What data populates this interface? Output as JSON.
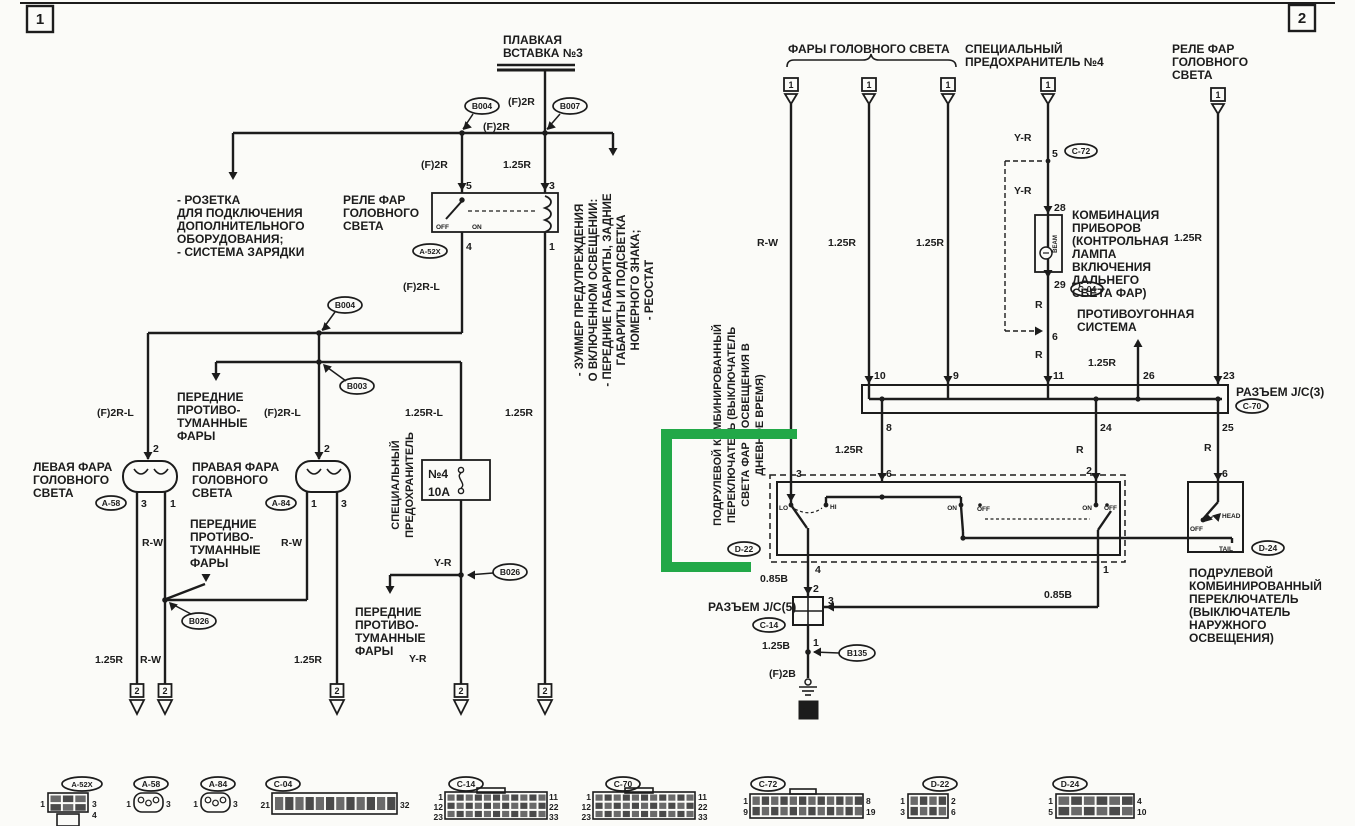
{
  "title": "Схема электрооборудования — фары головного света (стр. 1-2)",
  "colors": {
    "ink": "#1c1c1c",
    "paper": "#fbfbf8",
    "highlight": "#22a848"
  },
  "labels": [
    {
      "t": "1",
      "x": 40,
      "y": 24,
      "s": 15,
      "a": "middle"
    },
    {
      "t": "2",
      "x": 1302,
      "y": 23,
      "s": 15,
      "a": "middle"
    },
    {
      "t": "ПЛАВКАЯ",
      "x": 503,
      "y": 44
    },
    {
      "t": "ВСТАВКА №3",
      "x": 503,
      "y": 57
    },
    {
      "t": "(F)2R",
      "x": 508,
      "y": 105,
      "s": 10.5
    },
    {
      "t": "(F)2R",
      "x": 483,
      "y": 130,
      "s": 10.5
    },
    {
      "t": "(F)2R",
      "x": 421,
      "y": 168,
      "s": 10.5
    },
    {
      "t": "1.25R",
      "x": 503,
      "y": 168,
      "s": 10.5
    },
    {
      "t": "- РОЗЕТКА",
      "x": 177,
      "y": 204
    },
    {
      "t": "ДЛЯ ПОДКЛЮЧЕНИЯ",
      "x": 177,
      "y": 217
    },
    {
      "t": "ДОПОЛНИТЕЛЬНОГО",
      "x": 177,
      "y": 230
    },
    {
      "t": "ОБОРУДОВАНИЯ;",
      "x": 177,
      "y": 243
    },
    {
      "t": "- СИСТЕМА ЗАРЯДКИ",
      "x": 177,
      "y": 256
    },
    {
      "t": "РЕЛЕ ФАР",
      "x": 343,
      "y": 204
    },
    {
      "t": "ГОЛОВНОГО",
      "x": 343,
      "y": 217
    },
    {
      "t": "СВЕТА",
      "x": 343,
      "y": 230
    },
    {
      "t": "5",
      "x": 466,
      "y": 189,
      "s": 10.5
    },
    {
      "t": "3",
      "x": 549,
      "y": 189,
      "s": 10.5
    },
    {
      "t": "4",
      "x": 466,
      "y": 250,
      "s": 10.5
    },
    {
      "t": "1",
      "x": 549,
      "y": 250,
      "s": 10.5
    },
    {
      "t": "OFF",
      "x": 436,
      "y": 229,
      "s": 6.5
    },
    {
      "t": "ON",
      "x": 472,
      "y": 229,
      "s": 6.5
    },
    {
      "t": "(F)2R-L",
      "x": 403,
      "y": 290,
      "s": 10.5
    },
    {
      "t": "(F)2R-L",
      "x": 97,
      "y": 416,
      "s": 10.5
    },
    {
      "t": "(F)2R-L",
      "x": 264,
      "y": 416,
      "s": 10.5
    },
    {
      "t": "1.25R-L",
      "x": 405,
      "y": 416,
      "s": 10.5
    },
    {
      "t": "1.25R",
      "x": 505,
      "y": 416,
      "s": 10.5
    },
    {
      "t": "ПЕРЕДНИЕ",
      "x": 177,
      "y": 401
    },
    {
      "t": "ПРОТИВО-",
      "x": 177,
      "y": 414
    },
    {
      "t": "ТУМАННЫЕ",
      "x": 177,
      "y": 427
    },
    {
      "t": "ФАРЫ",
      "x": 177,
      "y": 440
    },
    {
      "t": "ЛЕВАЯ ФАРА",
      "x": 33,
      "y": 471
    },
    {
      "t": "ГОЛОВНОГО",
      "x": 33,
      "y": 484
    },
    {
      "t": "СВЕТА",
      "x": 33,
      "y": 497
    },
    {
      "t": "ПРАВАЯ ФАРА",
      "x": 192,
      "y": 471
    },
    {
      "t": "ГОЛОВНОГО",
      "x": 192,
      "y": 484
    },
    {
      "t": "СВЕТА",
      "x": 192,
      "y": 497
    },
    {
      "t": "2",
      "x": 153,
      "y": 452,
      "s": 10.5
    },
    {
      "t": "3",
      "x": 141,
      "y": 507,
      "s": 10.5
    },
    {
      "t": "1",
      "x": 170,
      "y": 507,
      "s": 10.5
    },
    {
      "t": "2",
      "x": 324,
      "y": 452,
      "s": 10.5
    },
    {
      "t": "1",
      "x": 311,
      "y": 507,
      "s": 10.5
    },
    {
      "t": "3",
      "x": 341,
      "y": 507,
      "s": 10.5
    },
    {
      "t": "R-W",
      "x": 142,
      "y": 546,
      "s": 10.5
    },
    {
      "t": "R-W",
      "x": 281,
      "y": 546,
      "s": 10.5
    },
    {
      "t": "ПЕРЕДНИЕ",
      "x": 190,
      "y": 528
    },
    {
      "t": "ПРОТИВО-",
      "x": 190,
      "y": 541
    },
    {
      "t": "ТУМАННЫЕ",
      "x": 190,
      "y": 554
    },
    {
      "t": "ФАРЫ",
      "x": 190,
      "y": 567
    },
    {
      "t": "СПЕЦИАЛЬНЫЙ",
      "x": 399,
      "y": 485,
      "r": 1,
      "a": "middle",
      "s": 11
    },
    {
      "t": "ПРЕДОХРАНИТЕЛЬ",
      "x": 413,
      "y": 485,
      "r": 1,
      "a": "middle",
      "s": 11
    },
    {
      "t": "№4",
      "x": 428,
      "y": 478
    },
    {
      "t": "10A",
      "x": 428,
      "y": 496
    },
    {
      "t": "Y-R",
      "x": 434,
      "y": 566,
      "s": 10.5
    },
    {
      "t": "ПЕРЕДНИЕ",
      "x": 355,
      "y": 616
    },
    {
      "t": "ПРОТИВО-",
      "x": 355,
      "y": 629
    },
    {
      "t": "ТУМАННЫЕ",
      "x": 355,
      "y": 642
    },
    {
      "t": "ФАРЫ",
      "x": 355,
      "y": 655
    },
    {
      "t": "1.25R",
      "x": 95,
      "y": 663,
      "s": 10.5
    },
    {
      "t": "R-W",
      "x": 140,
      "y": 663,
      "s": 10.5
    },
    {
      "t": "1.25R",
      "x": 294,
      "y": 663,
      "s": 10.5
    },
    {
      "t": "Y-R",
      "x": 409,
      "y": 662,
      "s": 10.5
    },
    {
      "t": "- ЗУММЕР ПРЕДУПРЕЖДЕНИЯ",
      "x": 583,
      "y": 290,
      "r": 1,
      "a": "middle",
      "s": 11.5
    },
    {
      "t": "О ВКЛЮЧЕННОМ ОСВЕЩЕНИИ:",
      "x": 597,
      "y": 290,
      "r": 1,
      "a": "middle",
      "s": 11.5
    },
    {
      "t": "- ПЕРЕДНИЕ ГАБАРИТЫ, ЗАДНИЕ",
      "x": 611,
      "y": 290,
      "r": 1,
      "a": "middle",
      "s": 11.5
    },
    {
      "t": "ГАБАРИТЫ И ПОДСВЕТКА",
      "x": 625,
      "y": 290,
      "r": 1,
      "a": "middle",
      "s": 11.5
    },
    {
      "t": "НОМЕРНОГО ЗНАКА;",
      "x": 639,
      "y": 290,
      "r": 1,
      "a": "middle",
      "s": 11.5
    },
    {
      "t": "- РЕОСТАТ",
      "x": 653,
      "y": 290,
      "r": 1,
      "a": "middle",
      "s": 11.5
    },
    {
      "t": "ФАРЫ ГОЛОВНОГО СВЕТА",
      "x": 788,
      "y": 53
    },
    {
      "t": "СПЕЦИАЛЬНЫЙ",
      "x": 965,
      "y": 53
    },
    {
      "t": "ПРЕДОХРАНИТЕЛЬ №4",
      "x": 965,
      "y": 66
    },
    {
      "t": "РЕЛЕ ФАР",
      "x": 1172,
      "y": 53
    },
    {
      "t": "ГОЛОВНОГО",
      "x": 1172,
      "y": 66
    },
    {
      "t": "СВЕТА",
      "x": 1172,
      "y": 79
    },
    {
      "t": "1",
      "x": 791,
      "y": 88,
      "s": 9,
      "a": "middle"
    },
    {
      "t": "1",
      "x": 869,
      "y": 88,
      "s": 9,
      "a": "middle"
    },
    {
      "t": "1",
      "x": 948,
      "y": 88,
      "s": 9,
      "a": "middle"
    },
    {
      "t": "1",
      "x": 1048,
      "y": 88,
      "s": 9,
      "a": "middle"
    },
    {
      "t": "1",
      "x": 1218,
      "y": 98,
      "s": 9,
      "a": "middle"
    },
    {
      "t": "R-W",
      "x": 757,
      "y": 246,
      "s": 10.5
    },
    {
      "t": "1.25R",
      "x": 828,
      "y": 246,
      "s": 10.5
    },
    {
      "t": "1.25R",
      "x": 916,
      "y": 246,
      "s": 10.5
    },
    {
      "t": "Y-R",
      "x": 1014,
      "y": 141,
      "s": 10.5
    },
    {
      "t": "5",
      "x": 1052,
      "y": 157,
      "s": 10.5
    },
    {
      "t": "Y-R",
      "x": 1014,
      "y": 194,
      "s": 10.5
    },
    {
      "t": "28",
      "x": 1054,
      "y": 211,
      "s": 10.5
    },
    {
      "t": "КОМБИНАЦИЯ",
      "x": 1072,
      "y": 219
    },
    {
      "t": "ПРИБОРОВ",
      "x": 1072,
      "y": 232
    },
    {
      "t": "(КОНТРОЛЬНАЯ",
      "x": 1072,
      "y": 245
    },
    {
      "t": "ЛАМПА",
      "x": 1072,
      "y": 258
    },
    {
      "t": "ВКЛЮЧЕНИЯ",
      "x": 1072,
      "y": 271
    },
    {
      "t": "ДАЛЬНЕГО",
      "x": 1072,
      "y": 284
    },
    {
      "t": "СВЕТА ФАР)",
      "x": 1072,
      "y": 297
    },
    {
      "t": "BEAM",
      "x": 1057,
      "y": 244,
      "s": 6,
      "r": 1,
      "a": "middle"
    },
    {
      "t": "29",
      "x": 1054,
      "y": 288,
      "s": 10.5
    },
    {
      "t": "R",
      "x": 1035,
      "y": 308,
      "s": 10.5
    },
    {
      "t": "1.25R",
      "x": 1174,
      "y": 241,
      "s": 10.5
    },
    {
      "t": "ПРОТИВОУГОННАЯ",
      "x": 1077,
      "y": 318
    },
    {
      "t": "СИСТЕМА",
      "x": 1077,
      "y": 331
    },
    {
      "t": "6",
      "x": 1052,
      "y": 340,
      "s": 10.5
    },
    {
      "t": "R",
      "x": 1035,
      "y": 358,
      "s": 10.5
    },
    {
      "t": "1.25R",
      "x": 1088,
      "y": 366,
      "s": 10.5
    },
    {
      "t": "10",
      "x": 874,
      "y": 379,
      "s": 10.5
    },
    {
      "t": "9",
      "x": 953,
      "y": 379,
      "s": 10.5
    },
    {
      "t": "11",
      "x": 1053,
      "y": 379,
      "s": 10.5
    },
    {
      "t": "26",
      "x": 1143,
      "y": 379,
      "s": 10.5
    },
    {
      "t": "23",
      "x": 1223,
      "y": 379,
      "s": 10.5
    },
    {
      "t": "РАЗЪЕМ J/C(3)",
      "x": 1236,
      "y": 396
    },
    {
      "t": "8",
      "x": 886,
      "y": 431,
      "s": 10.5
    },
    {
      "t": "24",
      "x": 1100,
      "y": 431,
      "s": 10.5
    },
    {
      "t": "25",
      "x": 1222,
      "y": 431,
      "s": 10.5
    },
    {
      "t": "1.25R",
      "x": 835,
      "y": 453,
      "s": 10.5
    },
    {
      "t": "R",
      "x": 1076,
      "y": 453,
      "s": 10.5
    },
    {
      "t": "R",
      "x": 1204,
      "y": 451,
      "s": 10.5
    },
    {
      "t": "3",
      "x": 796,
      "y": 477,
      "s": 10.5
    },
    {
      "t": "6",
      "x": 886,
      "y": 477,
      "s": 10.5
    },
    {
      "t": "2",
      "x": 1092,
      "y": 474,
      "s": 10.5,
      "a": "end"
    },
    {
      "t": "6",
      "x": 1222,
      "y": 477,
      "s": 10.5
    },
    {
      "t": "LO",
      "x": 788,
      "y": 510,
      "s": 6.5,
      "a": "end"
    },
    {
      "t": "HI",
      "x": 830,
      "y": 509,
      "s": 6.5
    },
    {
      "t": "ON",
      "x": 957,
      "y": 510,
      "s": 6.5,
      "a": "end"
    },
    {
      "t": "OFF",
      "x": 977,
      "y": 511,
      "s": 6.5
    },
    {
      "t": "ON",
      "x": 1092,
      "y": 510,
      "s": 6.5,
      "a": "end"
    },
    {
      "t": "OFF",
      "x": 1104,
      "y": 510,
      "s": 6.5
    },
    {
      "t": "OFF",
      "x": 1190,
      "y": 531,
      "s": 6.5
    },
    {
      "t": "HEAD",
      "x": 1222,
      "y": 518,
      "s": 6.5
    },
    {
      "t": "TAIL",
      "x": 1219,
      "y": 551,
      "s": 6.5
    },
    {
      "t": "4",
      "x": 815,
      "y": 573,
      "s": 10.5
    },
    {
      "t": "0.85B",
      "x": 760,
      "y": 582,
      "s": 10.5
    },
    {
      "t": "1",
      "x": 1103,
      "y": 573,
      "s": 10.5
    },
    {
      "t": "0.85B",
      "x": 1044,
      "y": 598,
      "s": 10.5
    },
    {
      "t": "2",
      "x": 813,
      "y": 592,
      "s": 10.5
    },
    {
      "t": "РАЗЪЕМ J/C(5)",
      "x": 708,
      "y": 611
    },
    {
      "t": "3",
      "x": 828,
      "y": 604,
      "s": 10.5
    },
    {
      "t": "1",
      "x": 813,
      "y": 646,
      "s": 10.5
    },
    {
      "t": "1.25B",
      "x": 762,
      "y": 649,
      "s": 10.5
    },
    {
      "t": "(F)2B",
      "x": 769,
      "y": 677,
      "s": 10.5
    },
    {
      "t": "10",
      "x": 808,
      "y": 714,
      "s": 9.5,
      "a": "middle",
      "inv": 1
    },
    {
      "t": "ПОДРУЛЕВОЙ",
      "x": 1189,
      "y": 577
    },
    {
      "t": "КОМБИНИРОВАННЫЙ",
      "x": 1189,
      "y": 590
    },
    {
      "t": "ПЕРЕКЛЮЧАТЕЛЬ",
      "x": 1189,
      "y": 603
    },
    {
      "t": "(ВЫКЛЮЧАТЕЛЬ",
      "x": 1189,
      "y": 616
    },
    {
      "t": "НАРУЖНОГО",
      "x": 1189,
      "y": 629
    },
    {
      "t": "ОСВЕЩЕНИЯ)",
      "x": 1189,
      "y": 642
    },
    {
      "t": "ПОДРУЛЕВОЙ КОМБИНИРОВАННЫЙ",
      "x": 721,
      "y": 425,
      "r": 1,
      "a": "middle",
      "s": 11
    },
    {
      "t": "ПЕРЕКЛЮЧАТЕЛЬ (ВЫКЛЮЧАТЕЛЬ",
      "x": 735,
      "y": 425,
      "r": 1,
      "a": "middle",
      "s": 11
    },
    {
      "t": "СВЕТА ФАР И ОСВЕЩЕНИЯ В",
      "x": 749,
      "y": 425,
      "r": 1,
      "a": "middle",
      "s": 11
    },
    {
      "t": "ДНЕВНОЕ ВРЕМЯ)",
      "x": 763,
      "y": 425,
      "r": 1,
      "a": "middle",
      "s": 11
    },
    {
      "t": "2",
      "x": 137,
      "y": 694,
      "s": 9,
      "a": "middle"
    },
    {
      "t": "2",
      "x": 165,
      "y": 694,
      "s": 9,
      "a": "middle"
    },
    {
      "t": "2",
      "x": 337,
      "y": 694,
      "s": 9,
      "a": "middle"
    },
    {
      "t": "2",
      "x": 461,
      "y": 694,
      "s": 9,
      "a": "middle"
    },
    {
      "t": "2",
      "x": 545,
      "y": 694,
      "s": 9,
      "a": "middle"
    },
    {
      "t": "1",
      "x": 45,
      "y": 807,
      "s": 8.5,
      "a": "end"
    },
    {
      "t": "3",
      "x": 92,
      "y": 807,
      "s": 8.5
    },
    {
      "t": "4",
      "x": 92,
      "y": 818,
      "s": 8.5
    },
    {
      "t": "1",
      "x": 131,
      "y": 807,
      "s": 8.5,
      "a": "end"
    },
    {
      "t": "3",
      "x": 166,
      "y": 807,
      "s": 8.5
    },
    {
      "t": "1",
      "x": 198,
      "y": 807,
      "s": 8.5,
      "a": "end"
    },
    {
      "t": "3",
      "x": 233,
      "y": 807,
      "s": 8.5
    },
    {
      "t": "21",
      "x": 270,
      "y": 808,
      "s": 8.5,
      "a": "end"
    },
    {
      "t": "32",
      "x": 400,
      "y": 808,
      "s": 8.5
    },
    {
      "t": "1",
      "x": 443,
      "y": 800,
      "s": 8.5,
      "a": "end"
    },
    {
      "t": "12",
      "x": 443,
      "y": 810,
      "s": 8.5,
      "a": "end"
    },
    {
      "t": "23",
      "x": 443,
      "y": 820,
      "s": 8.5,
      "a": "end"
    },
    {
      "t": "11",
      "x": 549,
      "y": 800,
      "s": 8.5
    },
    {
      "t": "22",
      "x": 549,
      "y": 810,
      "s": 8.5
    },
    {
      "t": "33",
      "x": 549,
      "y": 820,
      "s": 8.5
    },
    {
      "t": "1",
      "x": 591,
      "y": 800,
      "s": 8.5,
      "a": "end"
    },
    {
      "t": "12",
      "x": 591,
      "y": 810,
      "s": 8.5,
      "a": "end"
    },
    {
      "t": "23",
      "x": 591,
      "y": 820,
      "s": 8.5,
      "a": "end"
    },
    {
      "t": "11",
      "x": 698,
      "y": 800,
      "s": 8.5
    },
    {
      "t": "22",
      "x": 698,
      "y": 810,
      "s": 8.5
    },
    {
      "t": "33",
      "x": 698,
      "y": 820,
      "s": 8.5
    },
    {
      "t": "1",
      "x": 748,
      "y": 804,
      "s": 8.5,
      "a": "end"
    },
    {
      "t": "9",
      "x": 748,
      "y": 815,
      "s": 8.5,
      "a": "end"
    },
    {
      "t": "8",
      "x": 866,
      "y": 804,
      "s": 8.5
    },
    {
      "t": "19",
      "x": 866,
      "y": 815,
      "s": 8.5
    },
    {
      "t": "1",
      "x": 905,
      "y": 804,
      "s": 8.5,
      "a": "end"
    },
    {
      "t": "3",
      "x": 905,
      "y": 815,
      "s": 8.5,
      "a": "end"
    },
    {
      "t": "2",
      "x": 951,
      "y": 804,
      "s": 8.5
    },
    {
      "t": "6",
      "x": 951,
      "y": 815,
      "s": 8.5
    },
    {
      "t": "1",
      "x": 1053,
      "y": 804,
      "s": 8.5,
      "a": "end"
    },
    {
      "t": "5",
      "x": 1053,
      "y": 815,
      "s": 8.5,
      "a": "end"
    },
    {
      "t": "4",
      "x": 1137,
      "y": 804,
      "s": 8.5
    },
    {
      "t": "10",
      "x": 1137,
      "y": 815,
      "s": 8.5
    }
  ],
  "ovals": [
    {
      "t": "B004",
      "cx": 482,
      "cy": 106,
      "rx": 17,
      "ry": 8
    },
    {
      "t": "B007",
      "cx": 570,
      "cy": 106,
      "rx": 17,
      "ry": 8
    },
    {
      "t": "B004",
      "cx": 345,
      "cy": 305,
      "rx": 17,
      "ry": 8
    },
    {
      "t": "B003",
      "cx": 357,
      "cy": 386,
      "rx": 17,
      "ry": 8
    },
    {
      "t": "B026",
      "cx": 199,
      "cy": 621,
      "rx": 17,
      "ry": 8
    },
    {
      "t": "B026",
      "cx": 510,
      "cy": 572,
      "rx": 17,
      "ry": 8
    },
    {
      "t": "B135",
      "cx": 857,
      "cy": 653,
      "rx": 18,
      "ry": 8
    },
    {
      "t": "A-52X",
      "cx": 430,
      "cy": 251,
      "rx": 17,
      "ry": 7,
      "s": 7.5
    },
    {
      "t": "A-58",
      "cx": 111,
      "cy": 503,
      "rx": 15,
      "ry": 7
    },
    {
      "t": "A-84",
      "cx": 281,
      "cy": 503,
      "rx": 15,
      "ry": 7
    },
    {
      "t": "C-72",
      "cx": 1081,
      "cy": 151,
      "rx": 16,
      "ry": 7
    },
    {
      "t": "C-04",
      "cx": 1087,
      "cy": 289,
      "rx": 16,
      "ry": 7
    },
    {
      "t": "C-70",
      "cx": 1252,
      "cy": 406,
      "rx": 16,
      "ry": 7
    },
    {
      "t": "C-14",
      "cx": 769,
      "cy": 625,
      "rx": 16,
      "ry": 7
    },
    {
      "t": "D-22",
      "cx": 744,
      "cy": 549,
      "rx": 16,
      "ry": 7
    },
    {
      "t": "D-24",
      "cx": 1268,
      "cy": 548,
      "rx": 16,
      "ry": 7
    },
    {
      "t": "A-52X",
      "cx": 82,
      "cy": 784,
      "rx": 20,
      "ry": 7,
      "s": 7.5
    },
    {
      "t": "A-58",
      "cx": 151,
      "cy": 784,
      "rx": 17,
      "ry": 7
    },
    {
      "t": "A-84",
      "cx": 218,
      "cy": 784,
      "rx": 17,
      "ry": 7
    },
    {
      "t": "C-04",
      "cx": 283,
      "cy": 784,
      "rx": 17,
      "ry": 7
    },
    {
      "t": "C-14",
      "cx": 466,
      "cy": 784,
      "rx": 17,
      "ry": 7
    },
    {
      "t": "C-70",
      "cx": 623,
      "cy": 784,
      "rx": 17,
      "ry": 7
    },
    {
      "t": "C-72",
      "cx": 768,
      "cy": 784,
      "rx": 17,
      "ry": 7
    },
    {
      "t": "D-22",
      "cx": 940,
      "cy": 784,
      "rx": 17,
      "ry": 7
    },
    {
      "t": "D-24",
      "cx": 1070,
      "cy": 784,
      "rx": 17,
      "ry": 7
    }
  ]
}
